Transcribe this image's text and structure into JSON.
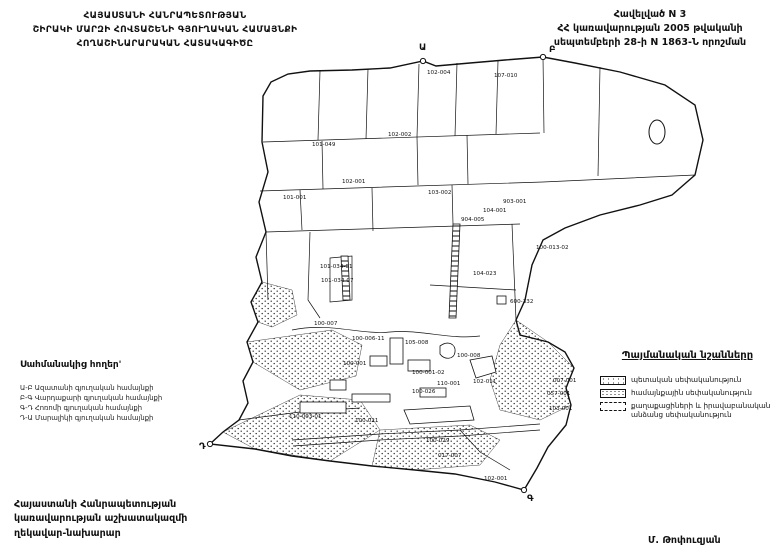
{
  "header": {
    "title_lines": [
      "ՀԱՅԱՍՏԱՆԻ ՀԱՆՐԱՊԵՏՈՒԹՅԱՆ",
      "ՇԻՐԱԿԻ ՄԱՐԶԻ ՀՈՎՏԱՇԵՆԻ ԳՅՈՒՂԱԿԱՆ ՀԱՄԱՅՆՔԻ",
      "ՀՈՂԱՇԻՆԱՐԱՐԱԿԱՆ ՀԱՏԱԿԱԳԻԾԸ"
    ],
    "annex_lines": [
      "Հավելված N 3",
      "ՀՀ կառավարության 2005 թվականի",
      "սեպտեմբերի 28-ի N 1863-Ն որոշման"
    ]
  },
  "legend_left": {
    "title": "Սահմանակից հողեր'",
    "items": [
      "Ա-Բ Ազատանի գյուղական համայնքի",
      "Բ-Գ Վարդաքարի գյուղական համայնքի",
      "Գ-Դ Հոռոմի գյուղական համայնքի",
      "Դ-Ա Մարալիկի գյուղական համայնքի"
    ]
  },
  "legend_right": {
    "title": "Պայմանական նշանները",
    "items": [
      {
        "pattern": "dots-sparse",
        "label": "պետական սեփականություն"
      },
      {
        "pattern": "dots-dense",
        "label": "համայնքային սեփականություն"
      },
      {
        "pattern": "dashed-empty",
        "label": "քաղաքացիների և իրավաբանական անձանց սեփականություն"
      }
    ]
  },
  "footer": {
    "left_lines": [
      "Հայաստանի Հանրապետության",
      "կառավարության աշխատակազմի",
      "ղեկավար-նախարար"
    ],
    "signature": "Մ. Թոփուզյան"
  },
  "map": {
    "corner_markers": [
      {
        "letter": "Ա",
        "x": 423,
        "y": 61,
        "lx": 419,
        "ly": 50
      },
      {
        "letter": "Բ",
        "x": 543,
        "y": 57,
        "lx": 549,
        "ly": 52
      },
      {
        "letter": "Գ",
        "x": 524,
        "y": 490,
        "lx": 527,
        "ly": 501
      },
      {
        "letter": "Դ",
        "x": 210,
        "y": 444,
        "lx": 199,
        "ly": 449
      }
    ],
    "parcel_labels": [
      {
        "t": "102-004",
        "x": 427,
        "y": 74
      },
      {
        "t": "107-010",
        "x": 494,
        "y": 77
      },
      {
        "t": "102-002",
        "x": 388,
        "y": 136
      },
      {
        "t": "101-049",
        "x": 312,
        "y": 146
      },
      {
        "t": "102-001",
        "x": 342,
        "y": 183
      },
      {
        "t": "101-001",
        "x": 283,
        "y": 199
      },
      {
        "t": "103-002",
        "x": 428,
        "y": 194
      },
      {
        "t": "903-001",
        "x": 503,
        "y": 203
      },
      {
        "t": "104-001",
        "x": 483,
        "y": 212
      },
      {
        "t": "904-005",
        "x": 461,
        "y": 221
      },
      {
        "t": "100-013-02",
        "x": 536,
        "y": 249
      },
      {
        "t": "104-023",
        "x": 473,
        "y": 275
      },
      {
        "t": "600-332",
        "x": 510,
        "y": 303
      },
      {
        "t": "101-034-01",
        "x": 320,
        "y": 268
      },
      {
        "t": "101-034-07",
        "x": 321,
        "y": 282
      },
      {
        "t": "100-007",
        "x": 314,
        "y": 325
      },
      {
        "t": "100-006-11",
        "x": 352,
        "y": 340
      },
      {
        "t": "105-008",
        "x": 405,
        "y": 344
      },
      {
        "t": "100-008",
        "x": 457,
        "y": 357
      },
      {
        "t": "100-001",
        "x": 343,
        "y": 365
      },
      {
        "t": "100-001-02",
        "x": 412,
        "y": 374
      },
      {
        "t": "110-001",
        "x": 437,
        "y": 385
      },
      {
        "t": "102-011",
        "x": 473,
        "y": 383
      },
      {
        "t": "100-026",
        "x": 412,
        "y": 393
      },
      {
        "t": "007-001",
        "x": 553,
        "y": 382
      },
      {
        "t": "057-001",
        "x": 547,
        "y": 395
      },
      {
        "t": "103-001",
        "x": 549,
        "y": 410
      },
      {
        "t": "110-003-01",
        "x": 289,
        "y": 418
      },
      {
        "t": "100-021",
        "x": 355,
        "y": 422
      },
      {
        "t": "100-029",
        "x": 426,
        "y": 442
      },
      {
        "t": "017-007",
        "x": 438,
        "y": 457
      },
      {
        "t": "102-001",
        "x": 484,
        "y": 480
      }
    ]
  }
}
